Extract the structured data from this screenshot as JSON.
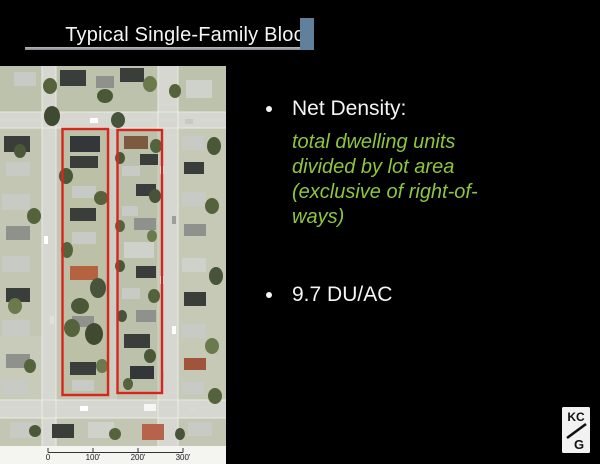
{
  "title": "Typical Single-Family Block",
  "content": {
    "bullet1": "Net Density:",
    "definition_lines": [
      "total dwelling units",
      "divided by lot area",
      "(exclusive of right-of-",
      "ways)"
    ],
    "bullet2": "9.7 DU/AC"
  },
  "map_figure": {
    "name": "aerial-photo-of-single-family-block",
    "scale_ticks": [
      "0",
      "100'",
      "200'",
      "300'"
    ]
  },
  "logo": {
    "name": "king-county-gis-logo",
    "line1": "KC",
    "line2": "G"
  },
  "colors": {
    "slide_background": "#000000",
    "title_text": "#f5f5f5",
    "title_rule": "#9aa0a5",
    "accent_square": "#61809b",
    "body_text": "#f5f5f5",
    "definition_green": "#8dc63f",
    "parcel_outline_red": "#d9251d",
    "scale_strip_background": "#f4f4f0"
  }
}
